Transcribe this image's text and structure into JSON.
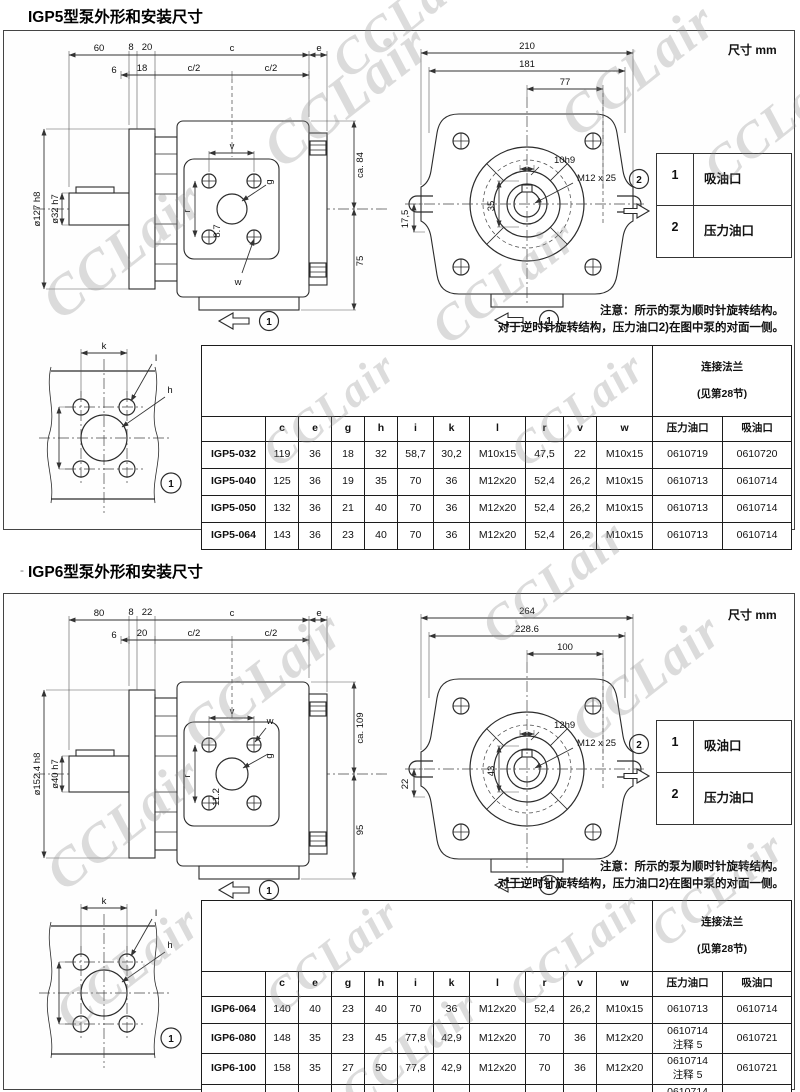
{
  "page": {
    "unit_label": "尺寸 mm",
    "watermark": "CCLair"
  },
  "legend": {
    "rows": [
      {
        "num": "1",
        "label": "吸油口"
      },
      {
        "num": "2",
        "label": "压力油口"
      }
    ]
  },
  "notes": {
    "line1": "注意：所示的泵为顺时针旋转结构。",
    "line2": "对于逆时针旋转结构，压力油口2)在图中泵的对面一侧。"
  },
  "table_common": {
    "flange_title": "连接法兰",
    "flange_sub": "(见第28节)",
    "columns": [
      "c",
      "e",
      "g",
      "h",
      "i",
      "k",
      "l",
      "r",
      "v",
      "w",
      "压力油口",
      "吸油口"
    ]
  },
  "igp5": {
    "title": "IGP5型泵外形和安装尺寸",
    "side": {
      "top": [
        "60",
        "8",
        "20",
        "c",
        "e"
      ],
      "top2": [
        "6",
        "18",
        "c/2",
        "c/2"
      ],
      "flange_dia": "ø127 h8",
      "shaft_dia": "ø32 h7",
      "right_top": "ca. 84",
      "right_bottom": "75",
      "label_v": "v",
      "label_g": "g",
      "label_r": "r",
      "label_center": "8.7",
      "label_w": "w",
      "pos1": "1"
    },
    "front": {
      "outer": "210",
      "inner": "181",
      "port": "77",
      "key": "10h9",
      "thread": "M12 x 25",
      "shaft_v": "35",
      "left": "17,5",
      "pos1": "1",
      "pos2": "2"
    },
    "flange_view": {
      "label_k": "k",
      "label_l": "l",
      "label_h": "h",
      "pos1": "1"
    },
    "rows": [
      {
        "model": "IGP5-032",
        "values": [
          "119",
          "36",
          "18",
          "32",
          "58,7",
          "30,2",
          "M10x15",
          "47,5",
          "22",
          "M10x15",
          "0610719",
          "0610720"
        ]
      },
      {
        "model": "IGP5-040",
        "values": [
          "125",
          "36",
          "19",
          "35",
          "70",
          "36",
          "M12x20",
          "52,4",
          "26,2",
          "M10x15",
          "0610713",
          "0610714"
        ]
      },
      {
        "model": "IGP5-050",
        "values": [
          "132",
          "36",
          "21",
          "40",
          "70",
          "36",
          "M12x20",
          "52,4",
          "26,2",
          "M10x15",
          "0610713",
          "0610714"
        ]
      },
      {
        "model": "IGP5-064",
        "values": [
          "143",
          "36",
          "23",
          "40",
          "70",
          "36",
          "M12x20",
          "52,4",
          "26,2",
          "M10x15",
          "0610713",
          "0610714"
        ]
      }
    ]
  },
  "igp6": {
    "title": "IGP6型泵外形和安装尺寸",
    "bullet": "-",
    "side": {
      "top": [
        "80",
        "8",
        "22",
        "c",
        "e"
      ],
      "top2": [
        "6",
        "20",
        "c/2",
        "c/2"
      ],
      "flange_dia": "ø152.4 h8",
      "shaft_dia": "ø40 h7",
      "right_top": "ca. 109",
      "right_bottom": "95",
      "label_v": "v",
      "label_g": "g",
      "label_r": "r",
      "label_center": "11.2",
      "label_w": "w",
      "pos1": "1"
    },
    "front": {
      "outer": "264",
      "inner": "228.6",
      "port": "100",
      "key": "12h9",
      "thread": "M12 x 25",
      "shaft_v": "43",
      "left": "22",
      "pos1": "1",
      "pos2": "2"
    },
    "flange_view": {
      "label_k": "k",
      "label_l": "l",
      "label_h": "h",
      "pos1": "1"
    },
    "rows": [
      {
        "model": "IGP6-064",
        "values": [
          "140",
          "40",
          "23",
          "40",
          "70",
          "36",
          "M12x20",
          "52,4",
          "26,2",
          "M10x15",
          "0610713",
          "0610714"
        ]
      },
      {
        "model": "IGP6-080",
        "values": [
          "148",
          "35",
          "23",
          "45",
          "77,8",
          "42,9",
          "M12x20",
          "70",
          "36",
          "M12x20",
          "0610714\n注释 5",
          "0610721"
        ]
      },
      {
        "model": "IGP6-100",
        "values": [
          "158",
          "35",
          "27",
          "50",
          "77,8",
          "42,9",
          "M12x20",
          "70",
          "36",
          "M12x20",
          "0610714\n注释 5",
          "0610721"
        ]
      },
      {
        "model": "IGP6-125",
        "values": [
          "170",
          "40",
          "30",
          "50",
          "77,8",
          "42,9",
          "M12x20",
          "70",
          "36",
          "M12x20",
          "0610714\n注释 5",
          "0610721"
        ]
      }
    ]
  }
}
